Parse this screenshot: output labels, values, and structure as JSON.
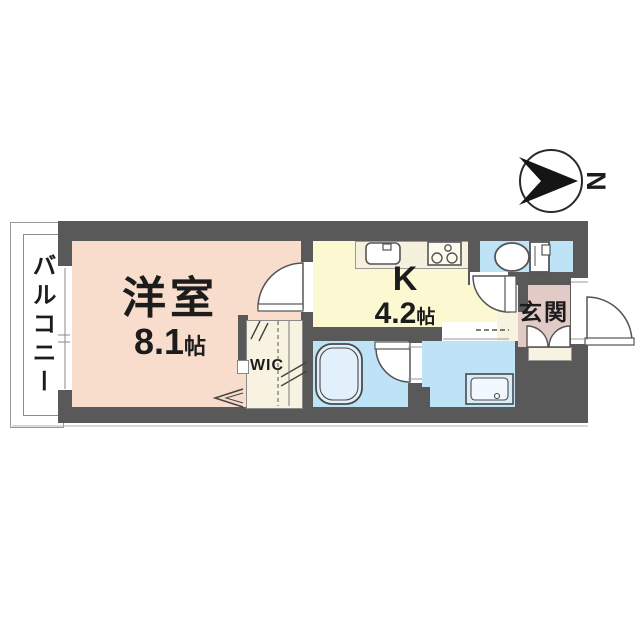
{
  "compass": {
    "north_label": "N"
  },
  "balcony": {
    "label": "バルコニー"
  },
  "rooms": {
    "western_room": {
      "name": "洋室",
      "size": "8.1",
      "size_unit": "帖"
    },
    "kitchen": {
      "label": "K",
      "size": "4.2",
      "size_unit": "帖"
    },
    "walk_in_closet": {
      "label": "WIC"
    },
    "entrance": {
      "name": "玄関"
    }
  },
  "fixtures": {
    "kitchen_sink": "sink-icon",
    "stove": "stove-icon",
    "toilet": "toilet-icon",
    "bathtub": "bathtub-icon",
    "washbasin": "washbasin-icon",
    "compass": "compass-north-icon"
  },
  "colors": {
    "wall": "#595959",
    "western_room": "#f8dccc",
    "kitchen": "#fbf8d2",
    "wet_rooms": "#bfe3f6",
    "entrance": "#e2cac6",
    "storage": "#f8f3e0",
    "line": "#777777"
  }
}
